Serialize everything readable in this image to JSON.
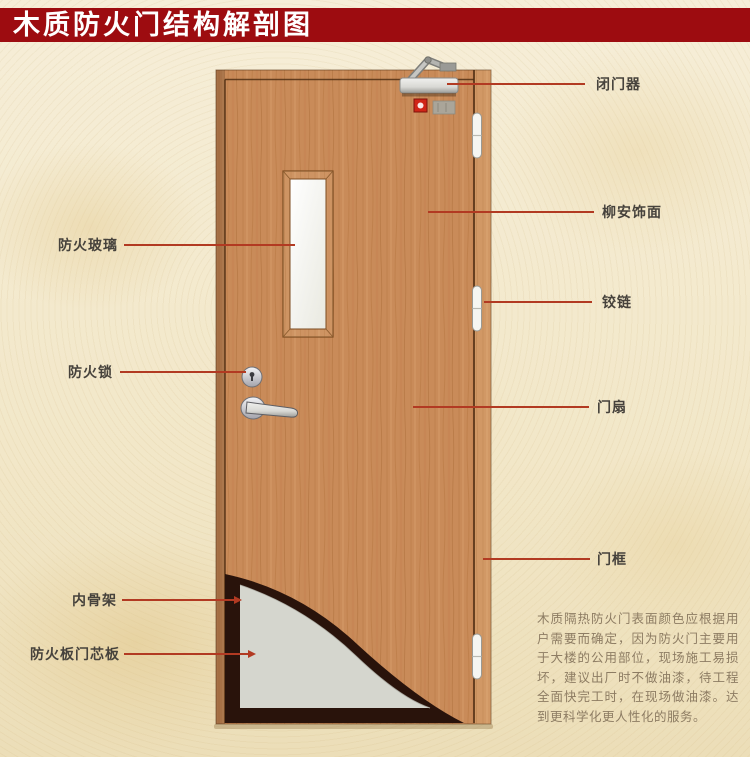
{
  "title": "木质防火门结构解剖图",
  "callouts": {
    "door_closer": {
      "label": "闭门器"
    },
    "lauan_veneer": {
      "label": "柳安饰面"
    },
    "hinge": {
      "label": "铰链"
    },
    "door_leaf": {
      "label": "门扇"
    },
    "door_frame": {
      "label": "门框"
    },
    "fire_glass": {
      "label": "防火玻璃"
    },
    "fire_lock": {
      "label": "防火锁"
    },
    "inner_skeleton": {
      "label": "内骨架"
    },
    "fire_core_board": {
      "label": "防火板门芯板"
    }
  },
  "description": "木质隔热防火门表面颜色应根据用户需要而确定，因为防火门主要用于大楼的公用部位，现场施工易损坏，建议出厂时不做油漆，待工程全面快完工时，在现场做油漆。达到更科学化更人性化的服务。",
  "colors": {
    "banner": "#9d0c10",
    "leader_line": "#b23a22",
    "wood": "#c98b59",
    "core_panel": "#d5d6ce",
    "skeleton_dark": "#29130b",
    "background": "#f2e8cb"
  }
}
